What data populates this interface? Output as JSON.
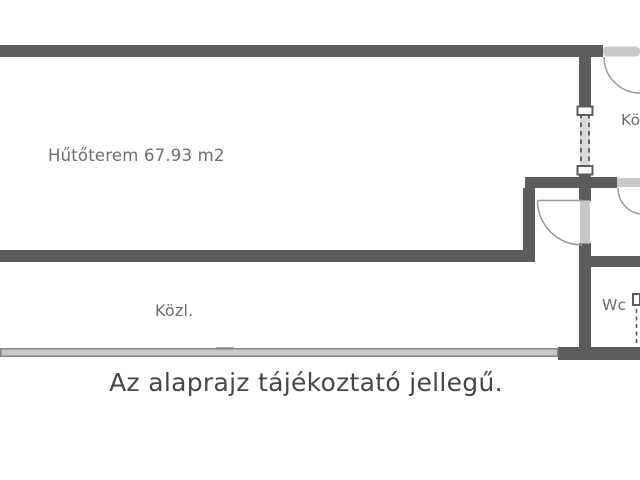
{
  "caption": "Az alaprajz tájékoztató jellegű.",
  "rooms": {
    "main": {
      "label": "Hűtőterem 67.93 m2"
    },
    "corridor": {
      "label": "Közl."
    },
    "wc": {
      "label": "Wc"
    },
    "top_right": {
      "label": "Kö"
    }
  },
  "colors": {
    "wall": "#5c5c5c",
    "opening": "#c8c8c8",
    "dashed_band": "#dadada",
    "wall_edge": "#868686",
    "door_arc": "#9b9b9b",
    "room_label": "#6e6e6e",
    "caption": "#46464b",
    "background": "#ffffff"
  }
}
